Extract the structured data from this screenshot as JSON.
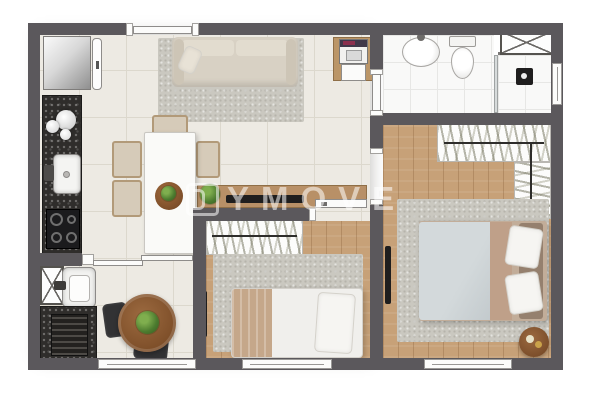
{
  "watermark": {
    "logo": "ymove-logo",
    "text": "YMOVE"
  },
  "palette": {
    "wall": "#5b585c",
    "floor_tile": "#edeae3",
    "wood_floor": "#c7a178",
    "granite": "#2f2d2b",
    "rug": "#cac8c0",
    "sofa": "#d8d1c4",
    "cabinet_wood": "#b89067",
    "duvet_master": "#ccd2d4",
    "blanket": "#bfa089",
    "plant": "#4c7b2f"
  },
  "plan": {
    "type": "apartment-floor-plan",
    "rooms": [
      {
        "name": "kitchen",
        "furniture": [
          "refrigerator",
          "tall-cabinet",
          "granite-counter",
          "round-bowls",
          "kitchen-sink",
          "cooktop"
        ]
      },
      {
        "name": "living-dining",
        "furniture": [
          "sofa",
          "area-rug",
          "washer-nook",
          "dining-table",
          "dining-chairs",
          "fruit-bowl",
          "sideboard",
          "tv",
          "plant"
        ]
      },
      {
        "name": "balcony-service",
        "furniture": [
          "duct-shaft",
          "laundry-tub",
          "service-counter",
          "louver-appliance",
          "round-table",
          "chairs",
          "plant",
          "window"
        ]
      },
      {
        "name": "bathroom",
        "furniture": [
          "wash-basin",
          "toilet",
          "shower",
          "duct-shaft",
          "window"
        ]
      },
      {
        "name": "master-bedroom",
        "furniture": [
          "double-bed",
          "open-wardrobe-hangers",
          "rug",
          "wall-tv",
          "round-side-table",
          "window"
        ]
      },
      {
        "name": "second-bedroom",
        "furniture": [
          "single-bed",
          "open-wardrobe-hangers",
          "rug",
          "wall-tv",
          "window"
        ]
      }
    ],
    "doors": [
      "entry-door-top",
      "bathroom-door",
      "master-bedroom-door",
      "second-bedroom-door",
      "balcony-sliding-door"
    ]
  }
}
